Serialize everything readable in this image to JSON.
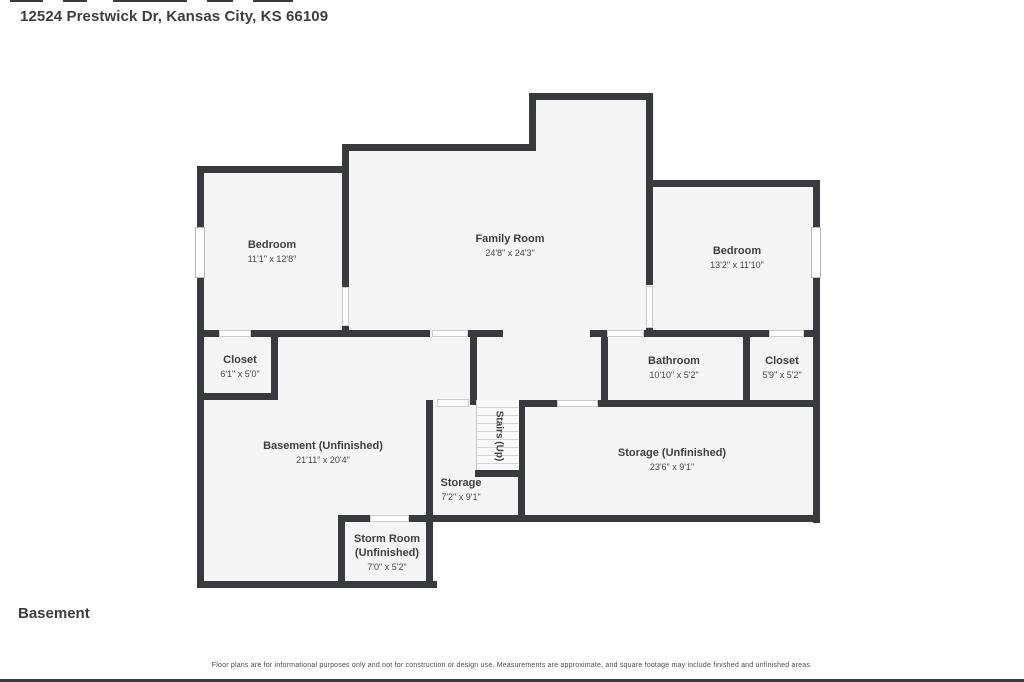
{
  "header": {
    "title": "12524 Prestwick Dr, Kansas City, KS 66109"
  },
  "footer": {
    "floor_label": "Basement",
    "disclaimer": "Floor plans are for informational purposes only and not for construction or design use. Measurements are approximate, and square footage may include finished and unfinished areas."
  },
  "colors": {
    "wall": "#393a3e",
    "room_fill": "#f5f5f5",
    "background": "#ffffff",
    "text": "#3e3f44"
  },
  "floor_plan": {
    "rooms": [
      {
        "id": "bedroom-left",
        "name": "Bedroom",
        "dimensions": "11'1\" x 12'8\""
      },
      {
        "id": "family-room",
        "name": "Family Room",
        "dimensions": "24'8\" x 24'3\""
      },
      {
        "id": "bedroom-right",
        "name": "Bedroom",
        "dimensions": "13'2\" x 11'10\""
      },
      {
        "id": "closet-left",
        "name": "Closet",
        "dimensions": "6'1\" x 5'0\""
      },
      {
        "id": "bathroom",
        "name": "Bathroom",
        "dimensions": "10'10\" x 5'2\""
      },
      {
        "id": "closet-right",
        "name": "Closet",
        "dimensions": "5'9\" x 5'2\""
      },
      {
        "id": "basement",
        "name": "Basement (Unfinished)",
        "dimensions": "21'11\" x 20'4\""
      },
      {
        "id": "storage",
        "name": "Storage",
        "dimensions": "7'2\" x 9'1\""
      },
      {
        "id": "storage-unfinished",
        "name": "Storage (Unfinished)",
        "dimensions": "23'6\" x 9'1\""
      },
      {
        "id": "storm-room",
        "name": "Storm Room (Unfinished)",
        "dimensions": "7'0\" x 5'2\""
      },
      {
        "id": "stairs",
        "name": "Stairs (Up)",
        "dimensions": ""
      }
    ]
  }
}
